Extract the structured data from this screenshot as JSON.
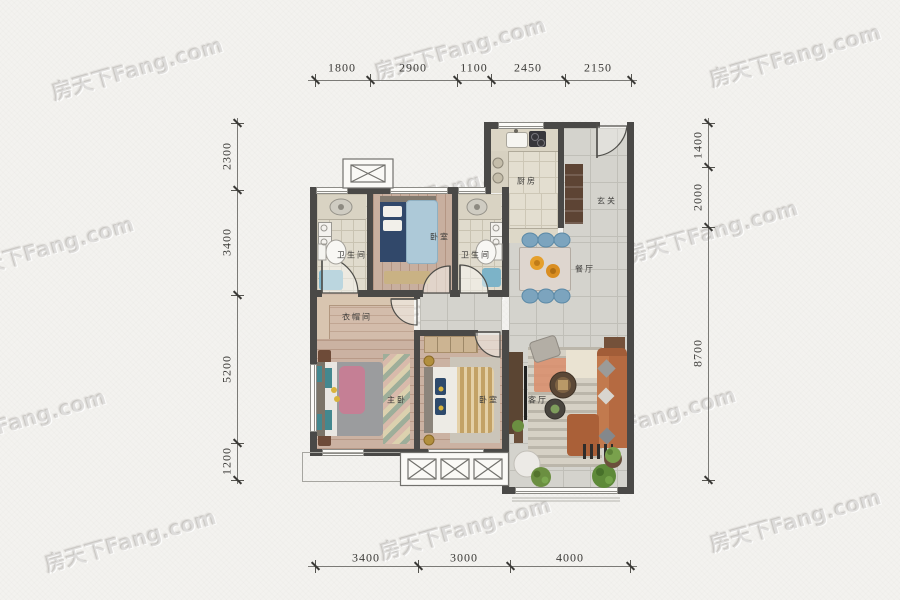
{
  "watermark": {
    "text": "房天下Fang.com"
  },
  "dims": {
    "top": [
      "1800",
      "2900",
      "1100",
      "2450",
      "2150"
    ],
    "bottom": [
      "3400",
      "3000",
      "4000"
    ],
    "left": [
      "2300",
      "3400",
      "5200",
      "1200"
    ],
    "right": [
      "1400",
      "2000",
      "8700"
    ]
  },
  "rooms": {
    "kitchen": "厨房",
    "foyer": "玄关",
    "dining": "餐厅",
    "bedroom_top": "卧室",
    "bath_left": "卫生间",
    "bath_right": "卫生间",
    "closet": "衣帽间",
    "master": "主卧",
    "bedroom_second": "卧室",
    "living": "客厅"
  },
  "colors": {
    "wall": "#4a4947",
    "tile_floor": "#d4d3cd",
    "wood_floor": "#cbb2a2",
    "sofa": "#b56a41",
    "bed_blue": "#adc9d8",
    "chair_blue": "#7ca4be",
    "blanket_pink": "#c57f95"
  }
}
